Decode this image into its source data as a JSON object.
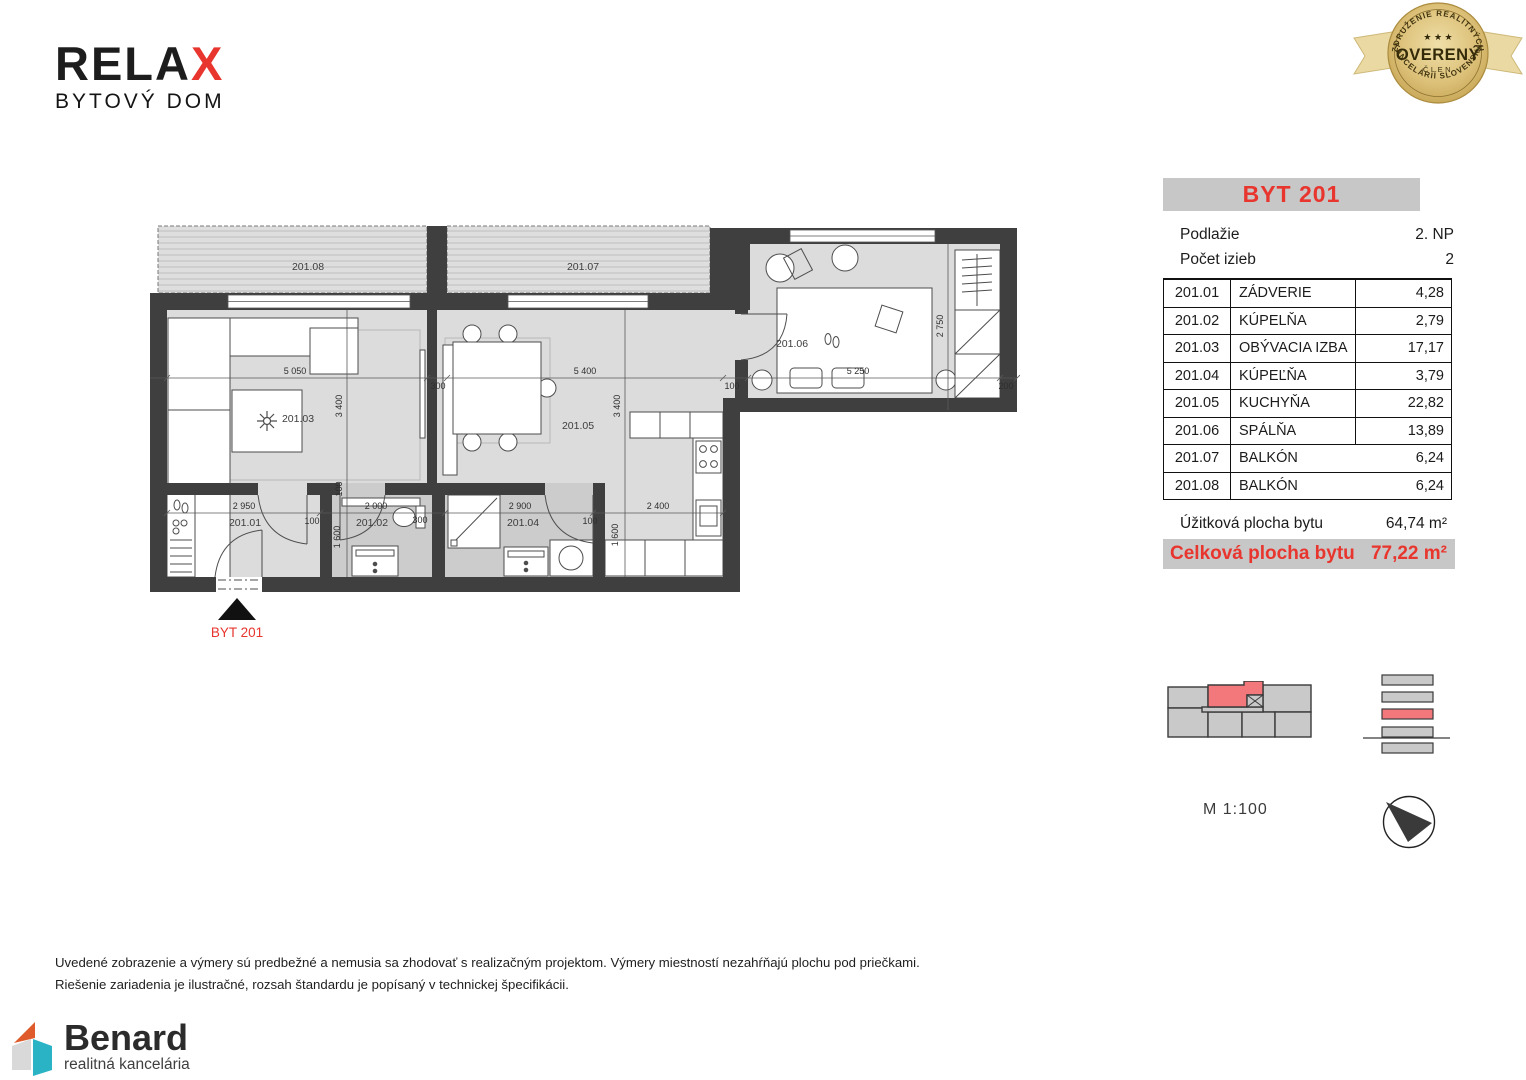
{
  "logo": {
    "text_main": "RELA",
    "text_accent": "X",
    "subtitle": "BYTOVÝ DOM"
  },
  "badge": {
    "arc_top": "ZDRUŽENIE REALITNÝCH",
    "stars": "★ ★ ★",
    "title": "OVERENÝ",
    "subtitle": "ČLEN",
    "arc_bottom": "KANCELÁRIÍ SLOVENSKA"
  },
  "panel": {
    "title": "BYT 201",
    "info": [
      {
        "label": "Podlažie",
        "value": "2. NP"
      },
      {
        "label": "Počet izieb",
        "value": "2"
      }
    ],
    "rooms": [
      {
        "code": "201.01",
        "name": "ZÁDVERIE",
        "area": "4,28"
      },
      {
        "code": "201.02",
        "name": "KÚPELŇA",
        "area": "2,79"
      },
      {
        "code": "201.03",
        "name": "OBÝVACIA IZBA",
        "area": "17,17"
      },
      {
        "code": "201.04",
        "name": "KÚPEĽŇA",
        "area": "3,79"
      },
      {
        "code": "201.05",
        "name": "KUCHYŇA",
        "area": "22,82"
      },
      {
        "code": "201.06",
        "name": "SPÁLŇA",
        "area": "13,89"
      },
      {
        "code": "201.07",
        "name": "BALKÓN",
        "area": "6,24"
      },
      {
        "code": "201.08",
        "name": "BALKÓN",
        "area": "6,24"
      }
    ],
    "usable": {
      "label": "Úžitková plocha bytu",
      "value": "64,74 m²"
    },
    "total": {
      "label": "Celková plocha bytu",
      "value": "77,22 m²"
    }
  },
  "plan": {
    "labels": {
      "r01": "201.01",
      "r02": "201.02",
      "r03": "201.03",
      "r04": "201.04",
      "r05": "201.05",
      "r06": "201.06",
      "r07": "201.07",
      "r08": "201.08"
    },
    "entrance": "BYT 201",
    "dims": {
      "top_5050": "5 050",
      "top_300": "300",
      "top_5400": "5 400",
      "top_100": "100",
      "top_5250": "5 250",
      "top_200": "200",
      "v_3400_a": "3 400",
      "v_100": "100",
      "v_1600_a": "1 600",
      "v_3400_b": "3 400",
      "v_1600_b": "1 600",
      "v_2750": "2 750",
      "bot_2950": "2 950",
      "bot_100_a": "100",
      "bot_2000": "2 000",
      "bot_300": "300",
      "bot_2900": "2 900",
      "bot_100_b": "100",
      "bot_2400": "2 400"
    }
  },
  "scale": {
    "label": "M 1:100"
  },
  "footer": {
    "line1": "Uvedené zobrazenie a výmery sú predbežné a nemusia sa zhodovať s realizačným projektom. Výmery miestností nezahŕňajú plochu pod priečkami.",
    "line2": "Riešenie zariadenia je ilustračné, rozsah štandardu je popísaný v technickej špecifikácii."
  },
  "brand": {
    "name": "Benard",
    "tagline": "realitná kancelária"
  }
}
